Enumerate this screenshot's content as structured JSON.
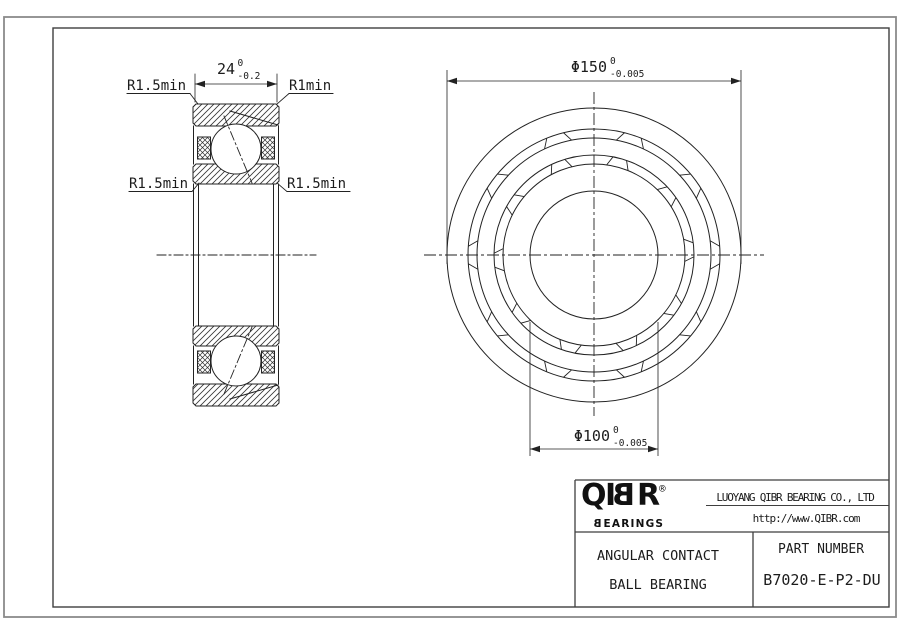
{
  "section_view": {
    "dim_width": {
      "value": "24",
      "tol_top": "0",
      "tol_bottom": "-0.2"
    },
    "label_top_left": "R1.5min",
    "label_top_right": "R1min",
    "label_mid_left": "R1.5min",
    "label_mid_right": "R1.5min"
  },
  "front_view": {
    "dim_outer": {
      "value": "Φ150",
      "tol_top": "0",
      "tol_bottom": "-0.005"
    },
    "dim_bore": {
      "value": "Φ100",
      "tol_top": "0",
      "tol_bottom": "-0.005"
    }
  },
  "title_block": {
    "logo_q": "Q",
    "logo_i": "I",
    "logo_b": "B",
    "logo_r": "R",
    "logo_reg": "®",
    "logo_sub_b": "B",
    "logo_sub_rest": "EARINGS",
    "company": "LUOYANG QIBR BEARING CO., LTD",
    "website": "http://www.QIBR.com",
    "product_line1": "ANGULAR CONTACT",
    "product_line2": "BALL BEARING",
    "part_label": "PART NUMBER",
    "part_number": "B7020-E-P2-DU"
  },
  "colors": {
    "line": "#222222",
    "frame_outer": "#8a8a8a",
    "frame_inner": "#3f3f3f",
    "text": "#1c1c1c"
  }
}
